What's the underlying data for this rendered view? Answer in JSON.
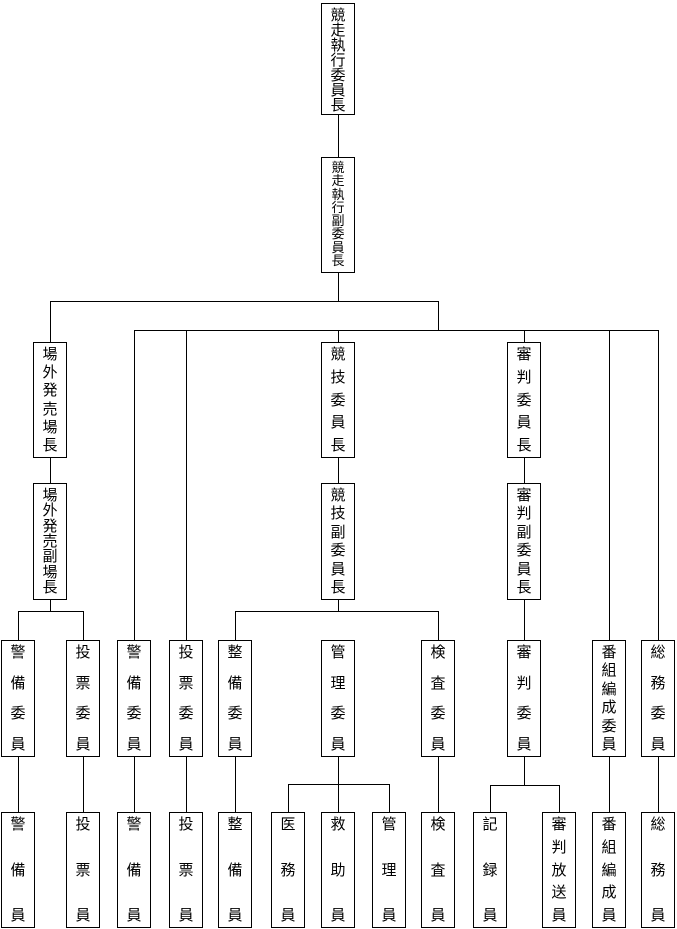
{
  "colors": {
    "background": "#ffffff",
    "line": "#000000",
    "box_border": "#000000",
    "text": "#000000"
  },
  "nodes": {
    "chairman": {
      "label": "競走執行委員長"
    },
    "vice_chairman": {
      "label": "競走執行副委員長"
    },
    "offtrack_sales_manager": {
      "label": "場外発売場長"
    },
    "offtrack_sales_deputy_manager": {
      "label": "場外発売副場長"
    },
    "race_committee_chief": {
      "label": "競技委員長"
    },
    "race_committee_deputy_chief": {
      "label": "競技副委員長"
    },
    "referee_committee_chief": {
      "label": "審判委員長"
    },
    "referee_committee_deputy_chief": {
      "label": "審判副委員長"
    },
    "guard_committee_offtrack": {
      "label": "警備委員"
    },
    "voting_committee_offtrack": {
      "label": "投票委員"
    },
    "guard_committee": {
      "label": "警備委員"
    },
    "voting_committee": {
      "label": "投票委員"
    },
    "maintenance_committee": {
      "label": "整備委員"
    },
    "management_committee": {
      "label": "管理委員"
    },
    "inspection_committee": {
      "label": "検査委員"
    },
    "referee_committee": {
      "label": "審判委員"
    },
    "program_committee": {
      "label": "番組編成委員"
    },
    "general_affairs_committee": {
      "label": "総務委員"
    },
    "guard_staff_offtrack": {
      "label": "警備員"
    },
    "voting_staff_offtrack": {
      "label": "投票員"
    },
    "guard_staff": {
      "label": "警備員"
    },
    "voting_staff": {
      "label": "投票員"
    },
    "maintenance_staff": {
      "label": "整備員"
    },
    "medical_staff": {
      "label": "医務員"
    },
    "rescue_staff": {
      "label": "救助員"
    },
    "management_staff": {
      "label": "管理員"
    },
    "inspection_staff": {
      "label": "検査員"
    },
    "record_staff": {
      "label": "記録員"
    },
    "referee_broadcast_staff": {
      "label": "審判放送員"
    },
    "program_staff": {
      "label": "番組編成員"
    },
    "general_affairs_staff": {
      "label": "総務員"
    }
  }
}
